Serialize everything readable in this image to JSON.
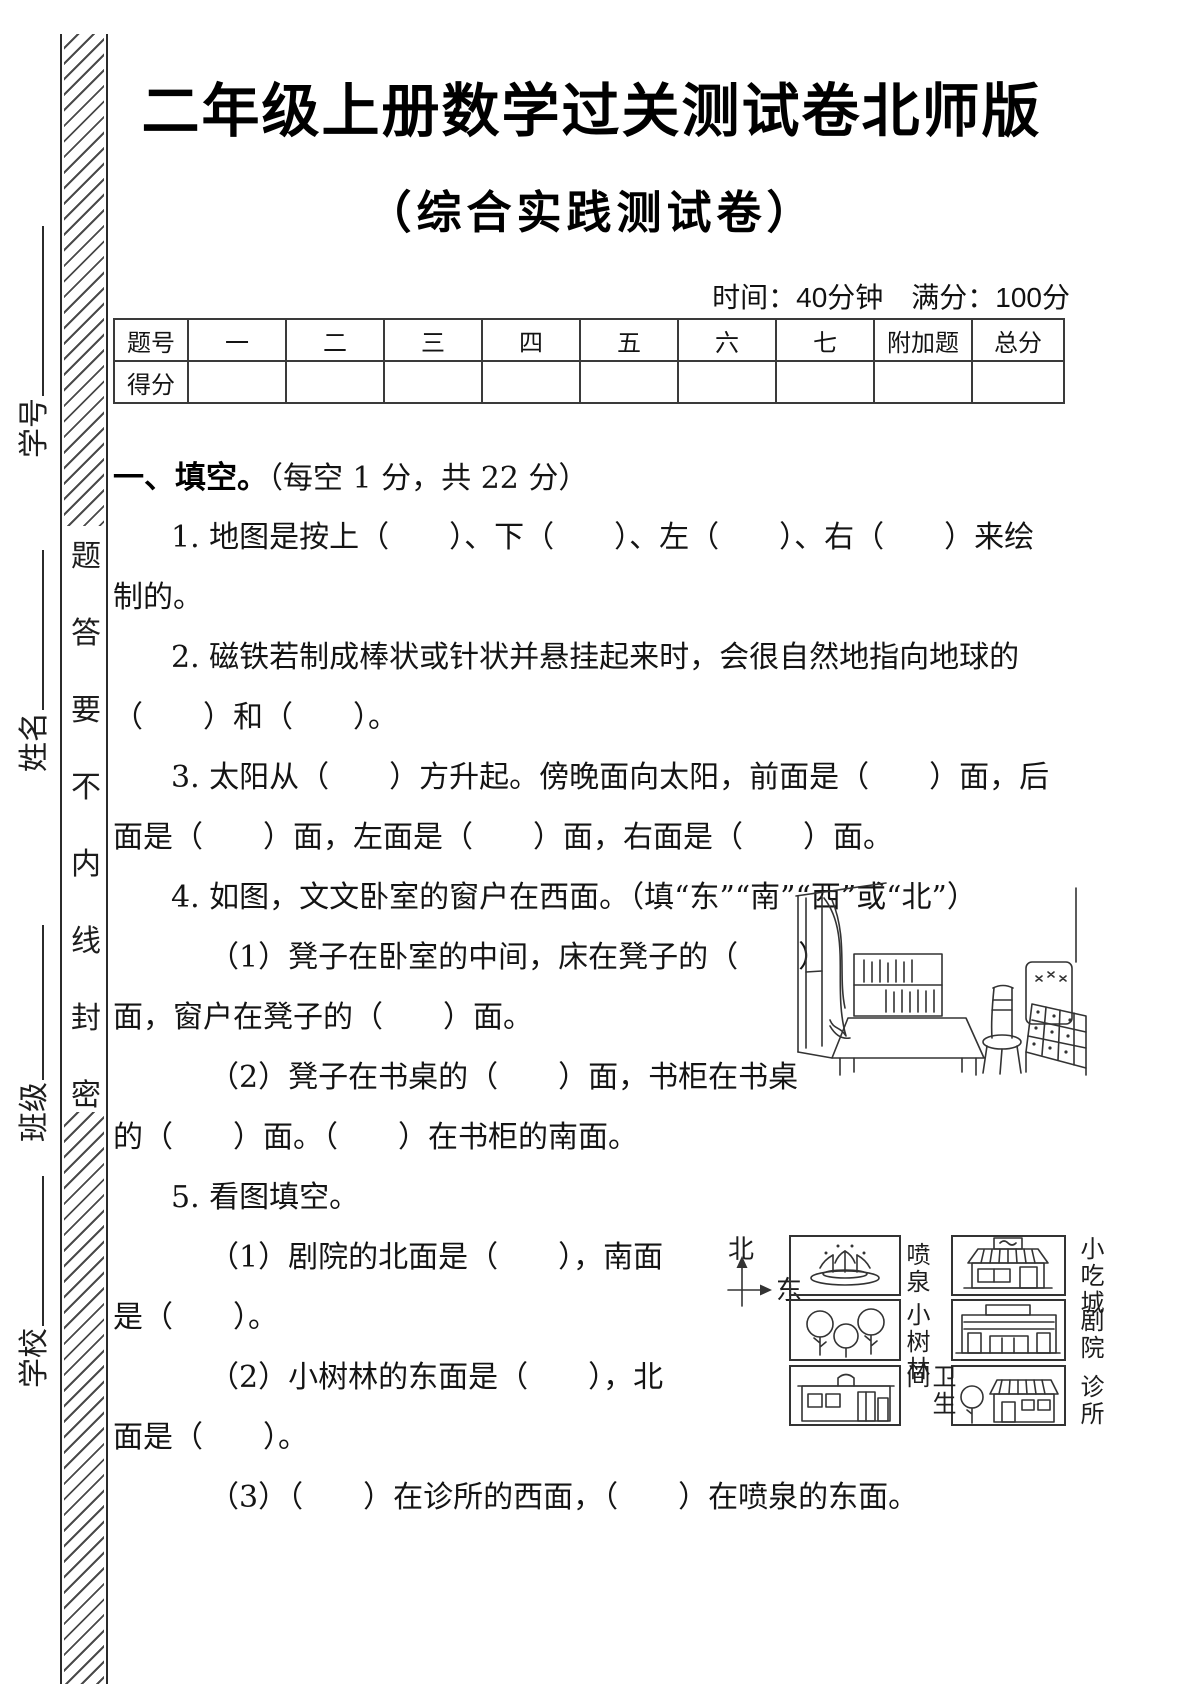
{
  "page": {
    "title": "二年级上册数学过关测试卷北师版",
    "subtitle": "（综合实践测试卷）",
    "meta": "时间：40分钟　满分：100分"
  },
  "sidebar": {
    "fields": [
      "学号",
      "姓名",
      "班级",
      "学校"
    ],
    "seal_text": [
      "密",
      "封",
      "线",
      "内",
      "不",
      "要",
      "答",
      "题"
    ]
  },
  "score_table": {
    "headers": [
      "题号",
      "一",
      "二",
      "三",
      "四",
      "五",
      "六",
      "七",
      "附加题",
      "总分"
    ],
    "row_label": "得分"
  },
  "section1": {
    "heading": "一、填空。",
    "note": "（每空 1 分，共 22 分）"
  },
  "lines": {
    "q1_1": "1. 地图是按上（　　）、下（　　）、左（　　）、右（　　）来绘",
    "q1_2": "制的。",
    "q2_1": "2. 磁铁若制成棒状或针状并悬挂起来时，会很自然地指向地球的",
    "q2_2": "（　　）和（　　）。",
    "q3_1": "3. 太阳从（　　）方升起。傍晚面向太阳，前面是（　　）面，后",
    "q3_2": "面是（　　）面，左面是（　　）面，右面是（　　）面。",
    "q4_0": "4. 如图，文文卧室的窗户在西面。（填“东”“南”“西”或“北”）",
    "q4_1a": "（1）凳子在卧室的中间，床在凳子的（　　）",
    "q4_1b": "面，窗户在凳子的（　　）面。",
    "q4_2a": "（2）凳子在书桌的（　　）面，书柜在书桌",
    "q4_2b": "的（　　）面。（　　）在书柜的南面。",
    "q5_0": "5. 看图填空。",
    "q5_1a": "（1）剧院的北面是（　　），南面",
    "q5_1b": "是（　　）。",
    "q5_2a": "（2）小树林的东面是（　　），北",
    "q5_2b": "面是（　　）。",
    "q5_3": "（3）（　　）在诊所的西面，（　　）在喷泉的东面。"
  },
  "map": {
    "compass_north": "北",
    "compass_east": "东",
    "places": [
      "喷泉",
      "小吃城",
      "小树林",
      "剧院",
      "卫生间",
      "诊所"
    ]
  }
}
